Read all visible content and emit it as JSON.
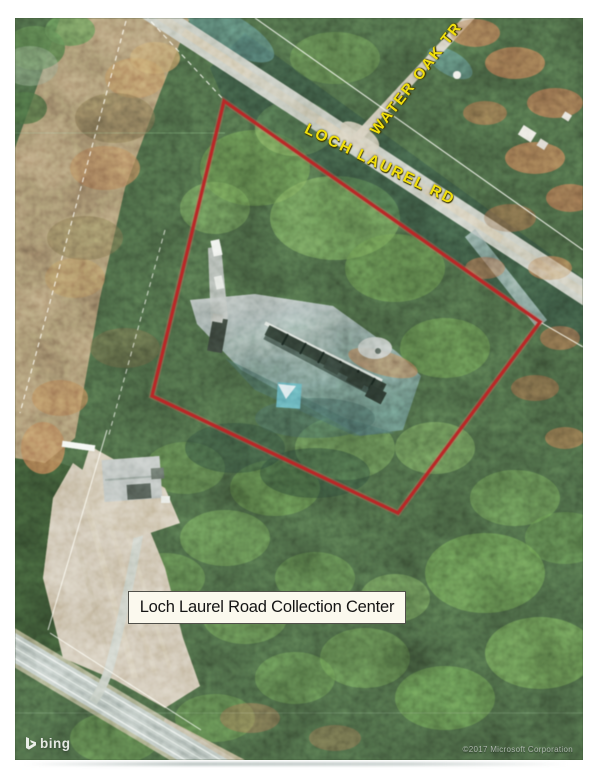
{
  "map": {
    "provider_logo": "bing",
    "attribution": "©2017 Microsoft Corporation",
    "road_labels": {
      "water_oak": "WATER OAK TR",
      "loch_laurel": "LOCH LAUREL RD"
    },
    "site_label": "Loch Laurel Road Collection Center",
    "boundary": {
      "color": "#c32020",
      "points_px": "209,83 525,304 383,495 137,378"
    },
    "colors": {
      "road_label_yellow": "#f1df0b",
      "forest_green": "#31482b",
      "cleared_brown": "#7d6a4e",
      "field_tan": "#b3a384",
      "pavement_gray": "#82918f",
      "canopy_teal": "#417f8d"
    }
  }
}
